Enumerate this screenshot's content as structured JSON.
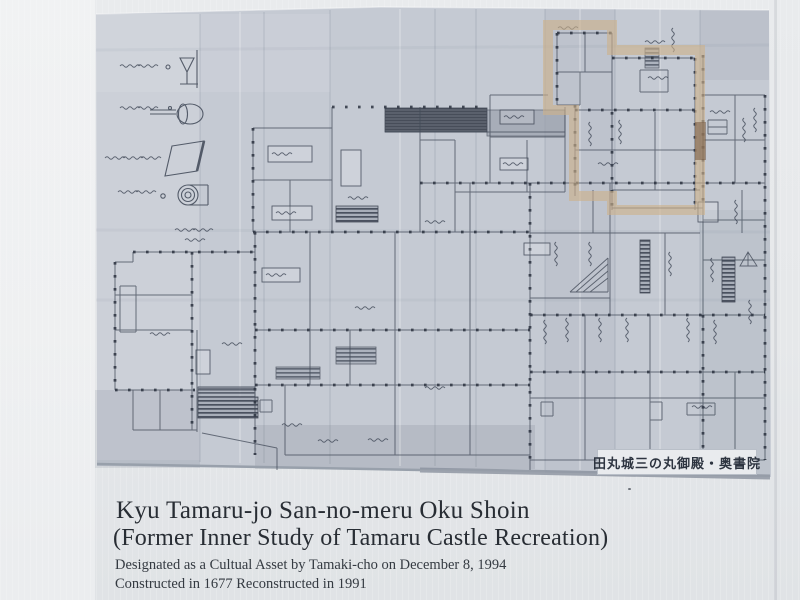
{
  "sign": {
    "title_line1": "Kyu Tamaru-jo San-no-meru Oku Shoin",
    "title_line2": "(Former Inner Study of Tamaru Castle Recreation)",
    "designated_line": "Designated as a Cultual Asset by Tamaki-cho on December 8, 1994",
    "constructed_line": "Constructed in 1677 Reconstructed in 1991"
  },
  "plan": {
    "caption": "田丸城三の丸御殿・奥書院",
    "colors": {
      "paper": "#c5cad3",
      "ink": "#424a58",
      "highlight": "#cdb18b",
      "sign_background": "#e7e9ec"
    }
  }
}
